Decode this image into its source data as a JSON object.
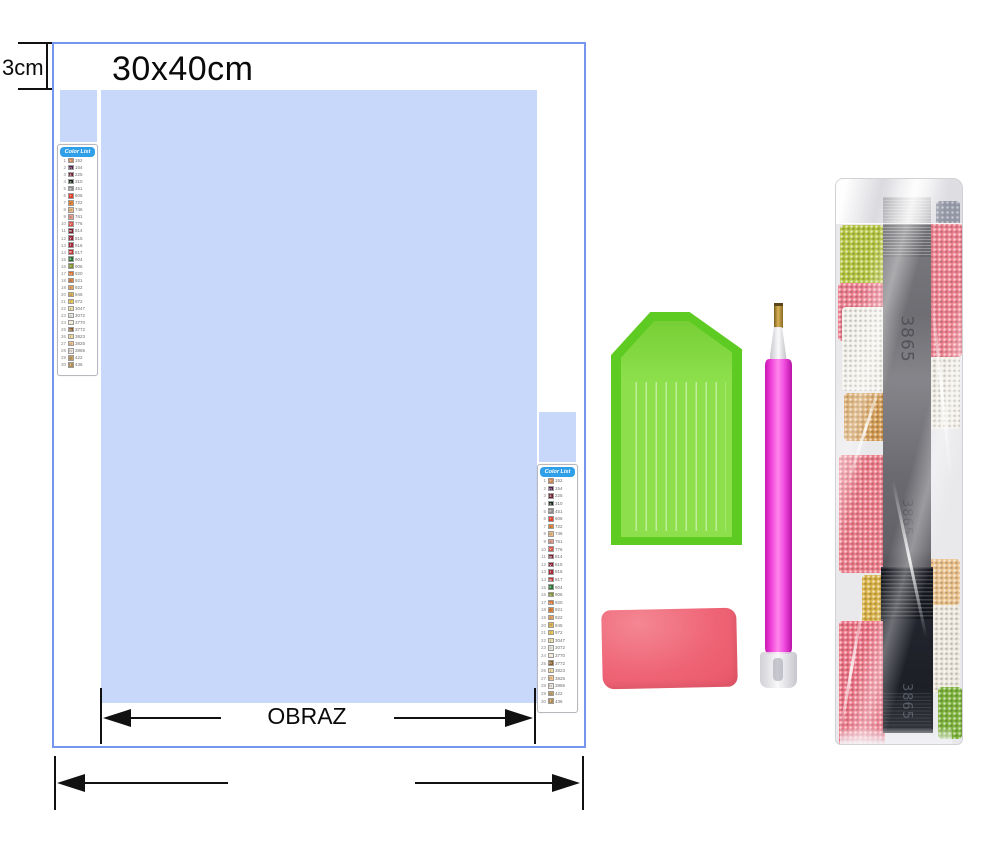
{
  "labels": {
    "margin": "3cm",
    "canvas_size": "30x40cm",
    "image_label": "OBRAZ"
  },
  "colors": {
    "canvas_border": "#7496ec",
    "print_area": "#c8d8fb",
    "list_header": "#2e9fe8",
    "tray_rim": "#5ecb22",
    "tray_face": "#8de04c",
    "pen_body": "#ee3fd6",
    "wax": "#ee6375",
    "bag_strip": "#6e6e73"
  },
  "color_list": {
    "header": "Color List",
    "rows": [
      {
        "n": 1,
        "code": "152",
        "hex": "#cf8450",
        "sym": "+"
      },
      {
        "n": 2,
        "code": "154",
        "hex": "#50224a",
        "sym": "n"
      },
      {
        "n": 3,
        "code": "225",
        "hex": "#6e2236",
        "sym": "4"
      },
      {
        "n": 4,
        "code": "310",
        "hex": "#1a2a18",
        "sym": "x"
      },
      {
        "n": 5,
        "code": "451",
        "hex": "#8d8a88",
        "sym": "e"
      },
      {
        "n": 6,
        "code": "606",
        "hex": "#e23c28",
        "sym": "+"
      },
      {
        "n": 7,
        "code": "722",
        "hex": "#e8862e",
        "sym": "z"
      },
      {
        "n": 8,
        "code": "746",
        "hex": "#ecbc80",
        "sym": "o"
      },
      {
        "n": 9,
        "code": "761",
        "hex": "#eb9d8a",
        "sym": "s"
      },
      {
        "n": 10,
        "code": "776",
        "hex": "#db5348",
        "sym": "v"
      },
      {
        "n": 11,
        "code": "814",
        "hex": "#7c1c2c",
        "sym": "m"
      },
      {
        "n": 12,
        "code": "815",
        "hex": "#8f2132",
        "sym": "y"
      },
      {
        "n": 13,
        "code": "816",
        "hex": "#a52536",
        "sym": "t"
      },
      {
        "n": 14,
        "code": "817",
        "hex": "#c23333",
        "sym": "w"
      },
      {
        "n": 15,
        "code": "904",
        "hex": "#226e2c",
        "sym": "k"
      },
      {
        "n": 16,
        "code": "906",
        "hex": "#7d8f2a",
        "sym": "c"
      },
      {
        "n": 17,
        "code": "920",
        "hex": "#da6e2a",
        "sym": "u"
      },
      {
        "n": 18,
        "code": "921",
        "hex": "#e28236",
        "sym": "a"
      },
      {
        "n": 19,
        "code": "922",
        "hex": "#eaa35e",
        "sym": "r"
      },
      {
        "n": 20,
        "code": "945",
        "hex": "#eaba52",
        "sym": "d"
      },
      {
        "n": 21,
        "code": "972",
        "hex": "#f2ca52",
        "sym": "7"
      },
      {
        "n": 22,
        "code": "3047",
        "hex": "#f0e2a6",
        "sym": "i"
      },
      {
        "n": 23,
        "code": "3072",
        "hex": "#eae9e2",
        "sym": "="
      },
      {
        "n": 24,
        "code": "3770",
        "hex": "#f6ecda",
        "sym": "."
      },
      {
        "n": 25,
        "code": "3772",
        "hex": "#8c5e2c",
        "sym": "b"
      },
      {
        "n": 26,
        "code": "3823",
        "hex": "#f2dc9e",
        "sym": "l"
      },
      {
        "n": 27,
        "code": "3825",
        "hex": "#f6c78e",
        "sym": "p"
      },
      {
        "n": 28,
        "code": "3865",
        "hex": "#eee9e0",
        "sym": "h"
      },
      {
        "n": 29,
        "code": "422",
        "hex": "#caa25e",
        "sym": "g"
      },
      {
        "n": 30,
        "code": "436",
        "hex": "#b28c4c",
        "sym": "f"
      }
    ]
  },
  "bag": {
    "code": "3865"
  }
}
